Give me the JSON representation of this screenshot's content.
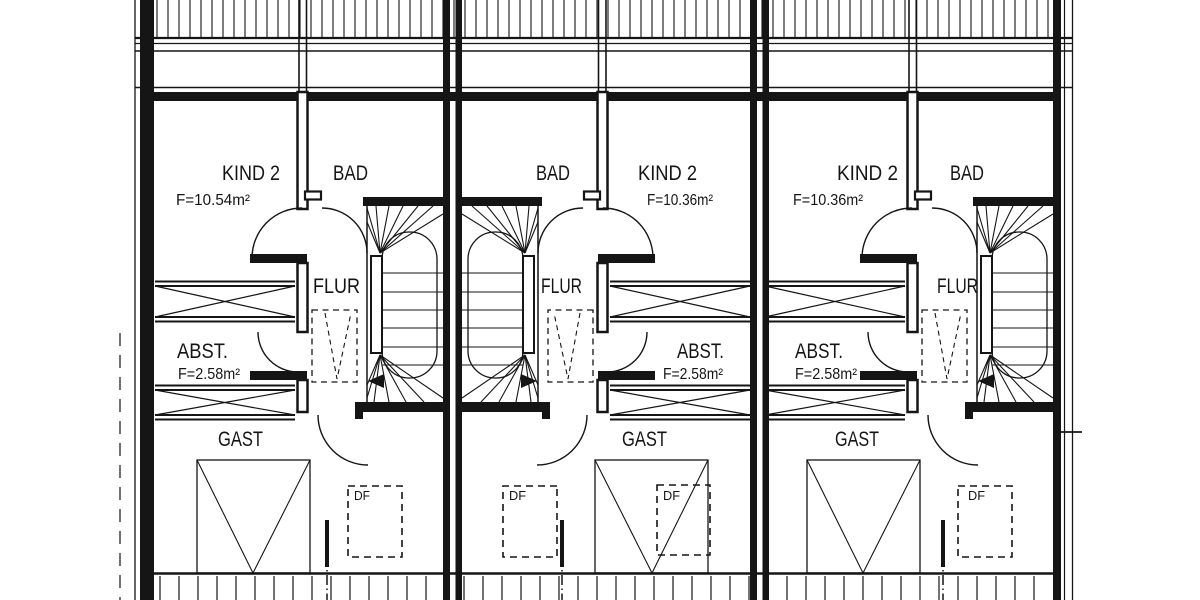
{
  "plan": {
    "colors": {
      "line": "#151515",
      "background": "#ffffff"
    },
    "units": [
      {
        "name": "unit-1",
        "rooms": {
          "kind": {
            "label": "KIND 2",
            "area": "F=10.54m²"
          },
          "bad": {
            "label": "BAD"
          },
          "flur": {
            "label": "FLUR"
          },
          "abst": {
            "label": "ABST.",
            "area": "F=2.58m²"
          },
          "gast": {
            "label": "GAST"
          }
        },
        "roof_windows": [
          {
            "label": "DF"
          }
        ]
      },
      {
        "name": "unit-2",
        "rooms": {
          "kind": {
            "label": "KIND 2",
            "area": "F=10.36m²"
          },
          "bad": {
            "label": "BAD"
          },
          "flur": {
            "label": "FLUR"
          },
          "abst": {
            "label": "ABST.",
            "area": "F=2.58m²"
          },
          "gast": {
            "label": "GAST"
          }
        },
        "roof_windows": [
          {
            "label": "DF"
          },
          {
            "label": "DF"
          }
        ]
      },
      {
        "name": "unit-3",
        "rooms": {
          "kind": {
            "label": "KIND 2",
            "area": "F=10.36m²"
          },
          "bad": {
            "label": "BAD"
          },
          "flur": {
            "label": "FLUR"
          },
          "abst": {
            "label": "ABST.",
            "area": "F=2.58m²"
          },
          "gast": {
            "label": "GAST"
          }
        },
        "roof_windows": [
          {
            "label": "DF"
          }
        ]
      }
    ]
  }
}
